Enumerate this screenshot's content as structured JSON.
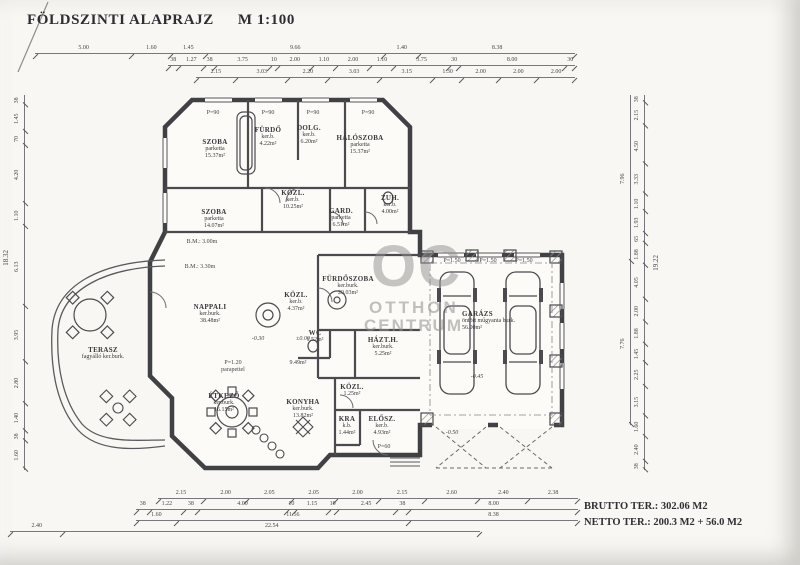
{
  "header": {
    "title": "FÖLDSZINTI ALAPRAJZ",
    "scale": "M 1:100"
  },
  "summary": {
    "brutto": "BRUTTO TER.: 302.06 M2",
    "netto": "NETTO TER.: 200.3 M2 + 56.0 M2"
  },
  "watermark": {
    "initials": "OC",
    "line1": "OTTHON",
    "line2": "CENTRUM"
  },
  "rooms": {
    "szoba1": {
      "name": "SZOBA",
      "floor": "parketta",
      "area": "15.37m²"
    },
    "furdo": {
      "name": "FÜRDŐ",
      "floor": "ker.b.",
      "area": "4.22m²"
    },
    "dolg": {
      "name": "DOLG.",
      "floor": "ker.b.",
      "area": "6.20m²"
    },
    "haloszoba": {
      "name": "HÁLÓSZOBA",
      "floor": "parketta",
      "area": "15.37m²"
    },
    "szoba2": {
      "name": "SZOBA",
      "floor": "parketta",
      "area": "14.07m²"
    },
    "kozl1": {
      "name": "KÖZL.",
      "floor": "ker.b.",
      "area": "10.25m²"
    },
    "gard": {
      "name": "GARD.",
      "floor": "parketta",
      "area": "6.51m²"
    },
    "zuh": {
      "name": "ZUH.",
      "floor": "ker.b.",
      "area": "4.00m²"
    },
    "nappali": {
      "name": "NAPPALI",
      "floor": "ker.burk.",
      "area": "38.48m²"
    },
    "furdoszoba": {
      "name": "FÜRDŐSZOBA",
      "floor": "ker.burk.",
      "area": "20.03m²"
    },
    "kozl2": {
      "name": "KÖZL.",
      "floor": "ker.b.",
      "area": "4.37m²"
    },
    "terasz": {
      "name": "TERASZ",
      "floor": "fagyálló ker.burk.",
      "area": ""
    },
    "etkezo": {
      "name": "ÉTKEZŐ",
      "floor": "ker.burk.",
      "area": "16.15m²"
    },
    "konyha": {
      "name": "KONYHA",
      "floor": "ker.burk.",
      "area": "13.82m²"
    },
    "hazth": {
      "name": "HÁZT.H.",
      "floor": "ker.burk.",
      "area": "5.25m²"
    },
    "kamra": {
      "name": "KRA",
      "floor": "k.b.",
      "area": "1.44m²"
    },
    "elosz": {
      "name": "ELŐSZ.",
      "floor": "ker.b.",
      "area": "4.93m²"
    },
    "kozl3": {
      "name": "KÖZL.",
      "floor": "",
      "area": "1.25m²"
    },
    "wc": {
      "name": "WC",
      "floor": "",
      "area": "1.52m²"
    },
    "garazs": {
      "name": "GARÁZS",
      "floor": "öntött műgyanta burk.",
      "area": "56.00m²"
    },
    "hall": {
      "name": "",
      "floor": "",
      "area": "9.49m²"
    }
  },
  "annotations": {
    "bm1": "B.M.: 3.00m",
    "bm2": "B.M.: 3.30m",
    "parapet_l1": "P=1.20",
    "parapet_l2": "parapettel",
    "p90": "P=90",
    "p150": "P=1.50",
    "p60": "P=60"
  },
  "levels": {
    "minus030": "-0.30",
    "zero": "±0.00",
    "minus045": "-0.45",
    "minus050": "-0.50"
  },
  "dims": {
    "top1": [
      "5.00",
      "1.60",
      "1.45",
      "9.66",
      "1.40",
      "8.38"
    ],
    "top2": [
      "38",
      "1.27",
      "38",
      "3.75",
      "10",
      "2.00",
      "1.10",
      "2.00",
      "1.10",
      "3.75",
      "30",
      "8.00",
      "30"
    ],
    "top3": [
      "2.15",
      "3.03",
      "2.20",
      "3.03",
      "3.15",
      "1.30",
      "2.00",
      "2.00",
      "2.00"
    ],
    "bottom1": [
      "2.15",
      "2.00",
      "2.05",
      "2.05",
      "2.00",
      "2.15",
      "2.60",
      "2.40",
      "2.38"
    ],
    "bottom2": [
      "38",
      "1.22",
      "38",
      "4.00",
      "10",
      "1.15",
      "10",
      "2.45",
      "38",
      "8.00"
    ],
    "bottom3": [
      "1.60",
      "11.56",
      "8.38"
    ],
    "bottom4": [
      "2.40",
      "22.54"
    ],
    "left": [
      "38",
      "1.45",
      "70",
      "4.20",
      "1.10",
      "6.13",
      "3.95",
      "2.80",
      "1.40",
      "38",
      "1.60"
    ],
    "left_total": "18.32",
    "right": [
      "38",
      "2.15",
      "4.50",
      "3.33",
      "1.10",
      "1.93",
      "65",
      "1.88",
      "4.05",
      "2.00",
      "1.88",
      "1.45",
      "2.25",
      "3.15",
      "1.60",
      "2.40",
      "38"
    ],
    "right_sub": [
      "7.96",
      "7.76"
    ],
    "right_total": "19.22"
  }
}
